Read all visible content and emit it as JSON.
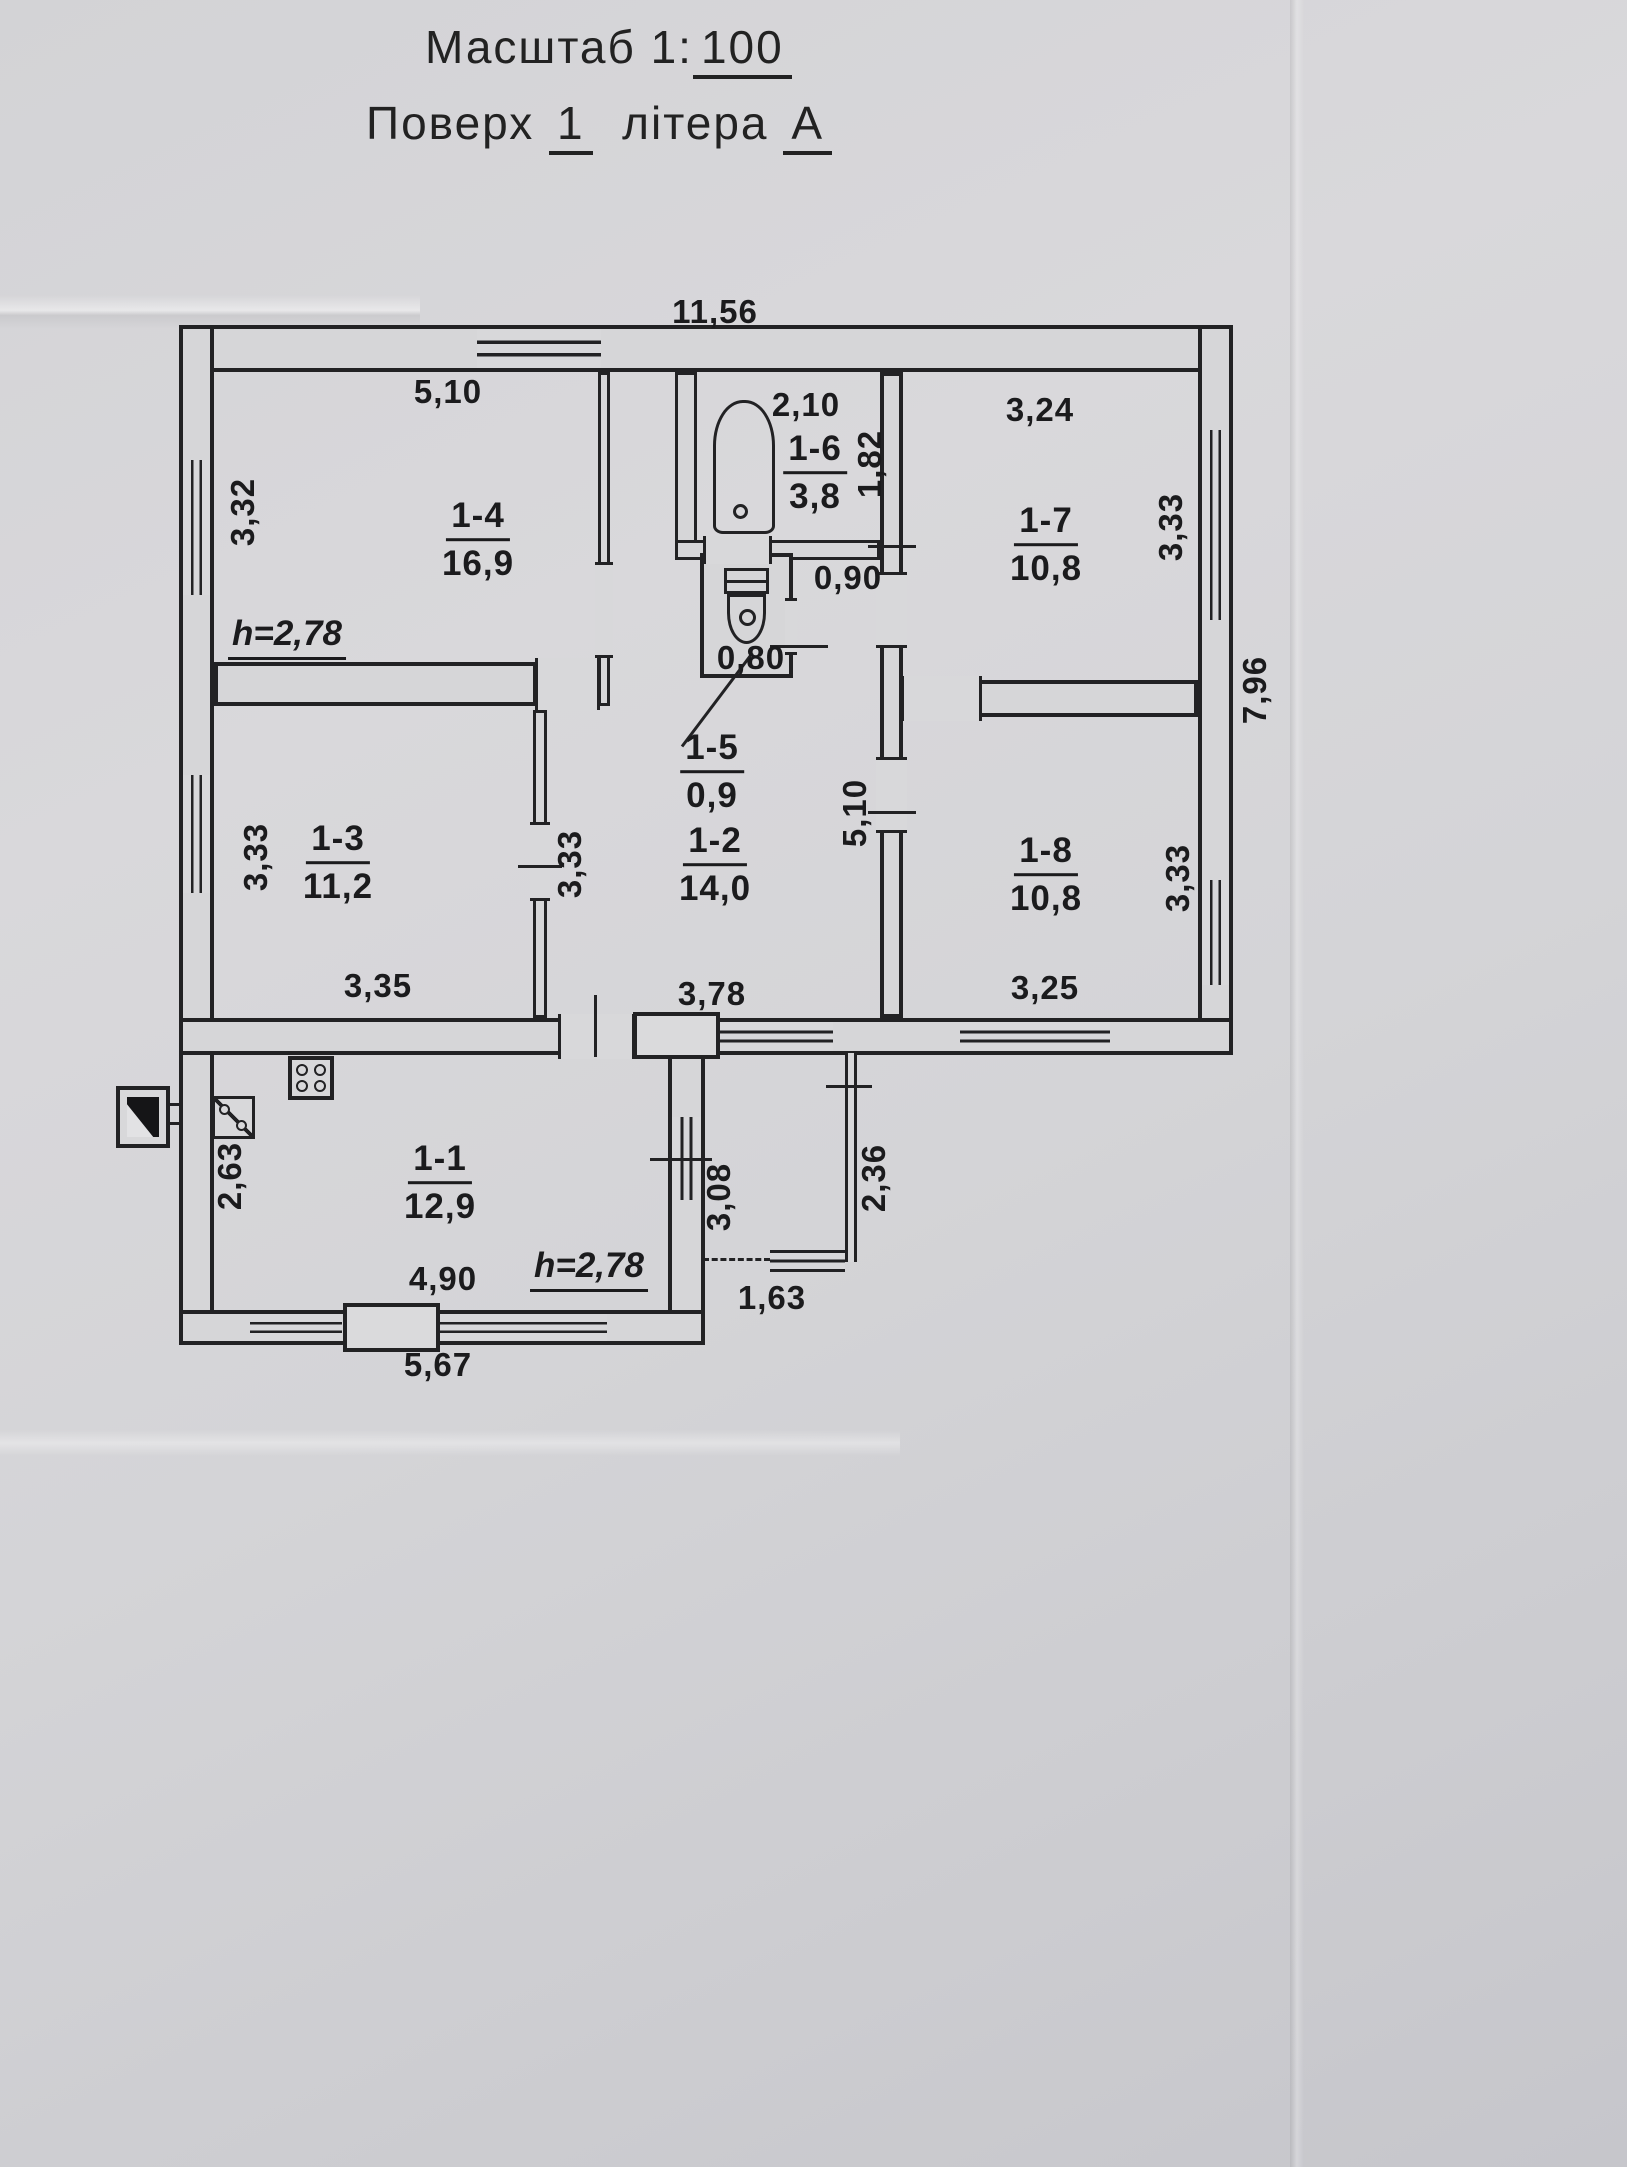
{
  "title": {
    "scale_label": "Масштаб 1:",
    "scale_value": "100",
    "floor_label": "Поверх",
    "floor_value": "1",
    "letter_label": "літера",
    "letter_value": "А"
  },
  "rooms": {
    "r11": {
      "number": "1-1",
      "area": "12,9"
    },
    "r12": {
      "number": "1-2",
      "area": "14,0"
    },
    "r13": {
      "number": "1-3",
      "area": "11,2"
    },
    "r14": {
      "number": "1-4",
      "area": "16,9"
    },
    "r15": {
      "number": "1-5",
      "area": "0,9"
    },
    "r16": {
      "number": "1-6",
      "area": "3,8"
    },
    "r17": {
      "number": "1-7",
      "area": "10,8"
    },
    "r18": {
      "number": "1-8",
      "area": "10,8"
    }
  },
  "dimensions": {
    "building_top": "11,56",
    "building_right": "7,96",
    "r14_top": "5,10",
    "r14_left": "3,32",
    "bath_width": "2,10",
    "bath_height": "1,82",
    "r17_top": "3,24",
    "r17_right": "3,33",
    "toilet_width": "0,80",
    "corridor_width": "0,90",
    "hall_wall": "5,10",
    "r13_left": "3,33",
    "r13_partition": "3,33",
    "r13_bottom": "3,35",
    "r12_bottom": "3,78",
    "r18_right": "3,33",
    "r18_bottom": "3,25",
    "kitchen_left": "2,63",
    "kitchen_bottom": "4,90",
    "kitchen_bottom_outer": "5,67",
    "kitchen_right": "3,08",
    "porch_side": "2,36",
    "porch_bottom": "1,63",
    "ceiling_height_main": "h=2,78",
    "ceiling_height_kitchen": "h=2,78"
  },
  "icons": {
    "bathtub": "bathtub-symbol",
    "toilet": "toilet-symbol",
    "stove": "stove-symbol",
    "sink": "sink-symbol",
    "chimney": "chimney-symbol"
  },
  "colors": {
    "paper": "#d6d6d8",
    "ink": "#222224"
  }
}
